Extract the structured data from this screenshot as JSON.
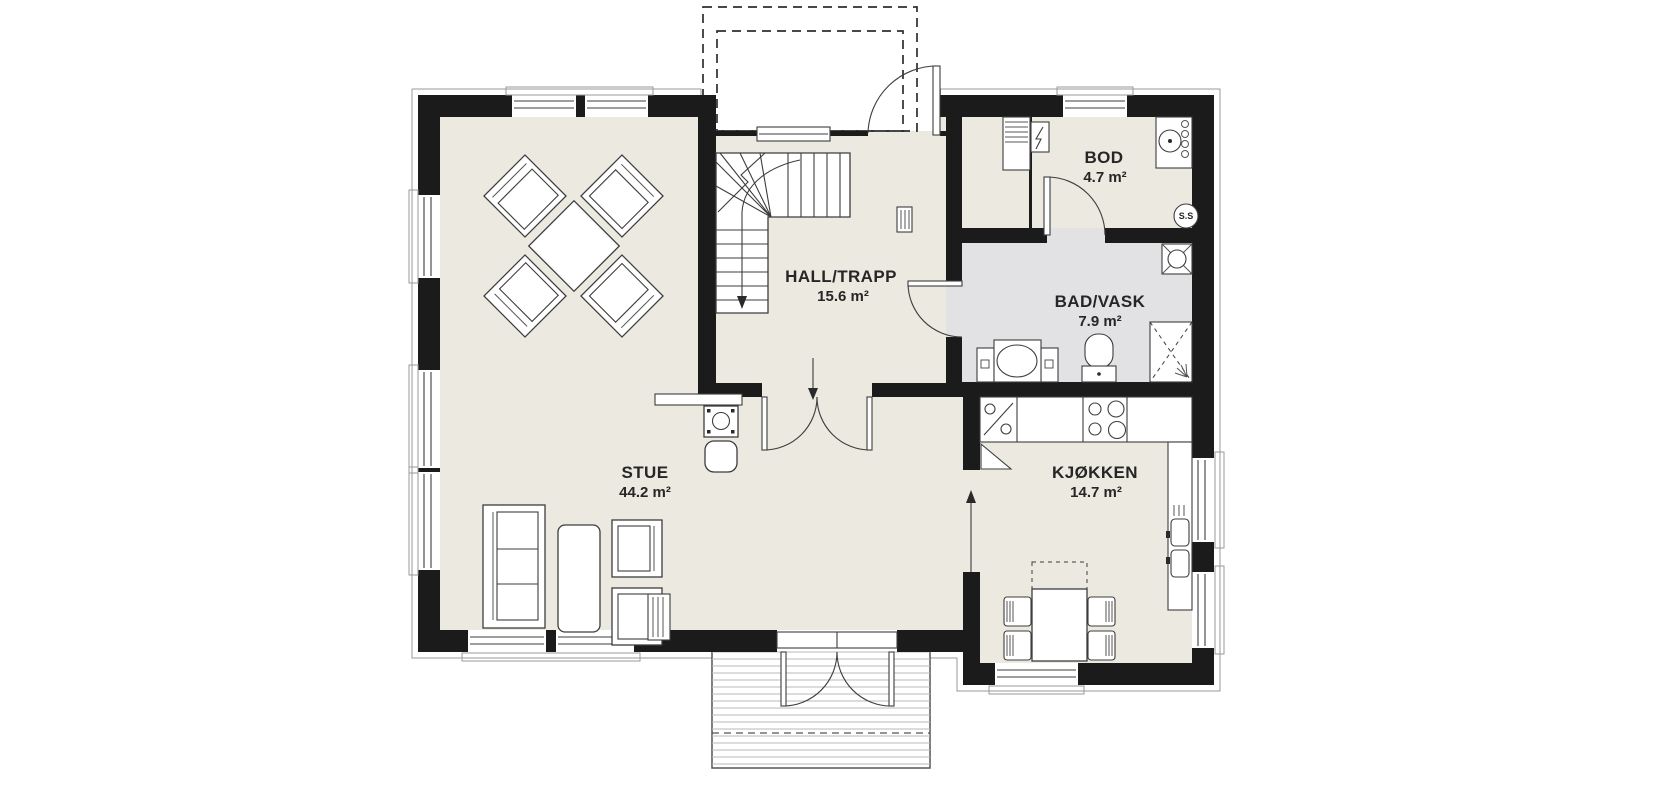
{
  "rooms": [
    {
      "id": "stue",
      "name": "STUE",
      "area": "44.2 m²"
    },
    {
      "id": "hall",
      "name": "HALL/TRAPP",
      "area": "15.6 m²"
    },
    {
      "id": "bod",
      "name": "BOD",
      "area": "4.7 m²"
    },
    {
      "id": "bad",
      "name": "BAD/VASK",
      "area": "7.9 m²"
    },
    {
      "id": "kjokken",
      "name": "KJØKKEN",
      "area": "14.7 m²"
    }
  ],
  "annotations": {
    "shaft_label": "S.S"
  },
  "colors": {
    "wall": "#1b1b1b",
    "floor_main": "#ebe9e0",
    "floor_bath": "#e2e2e4",
    "background": "#ffffff",
    "line": "#3d3d3d"
  }
}
